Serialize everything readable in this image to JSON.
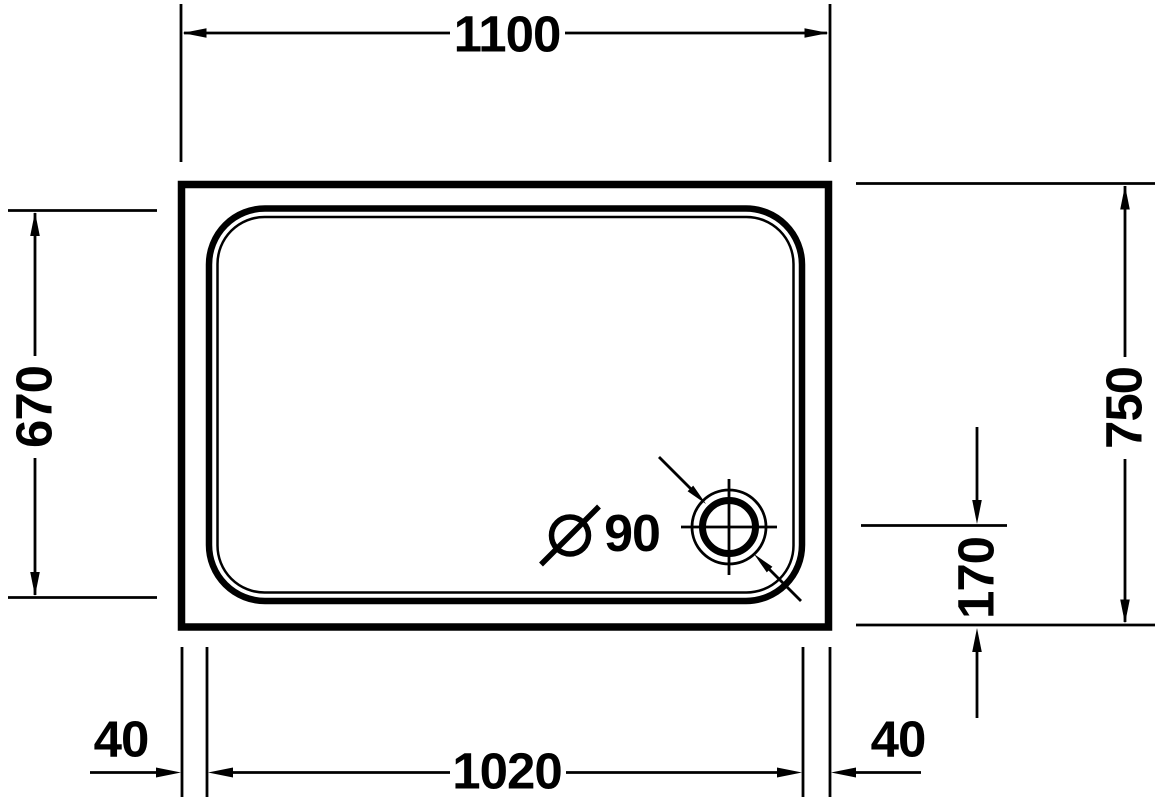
{
  "colors": {
    "line": "#000000",
    "background": "#ffffff"
  },
  "drawing": {
    "dimensions": {
      "outer_width": "1100",
      "inner_depth": "670",
      "outer_depth": "750",
      "drain_offset_bottom": "170",
      "rim_left": "40",
      "inner_width": "1020",
      "rim_right": "40"
    },
    "drain": {
      "diameter_symbol": "Ø",
      "diameter_value": "90",
      "diameter_label": "Ø 90"
    }
  }
}
